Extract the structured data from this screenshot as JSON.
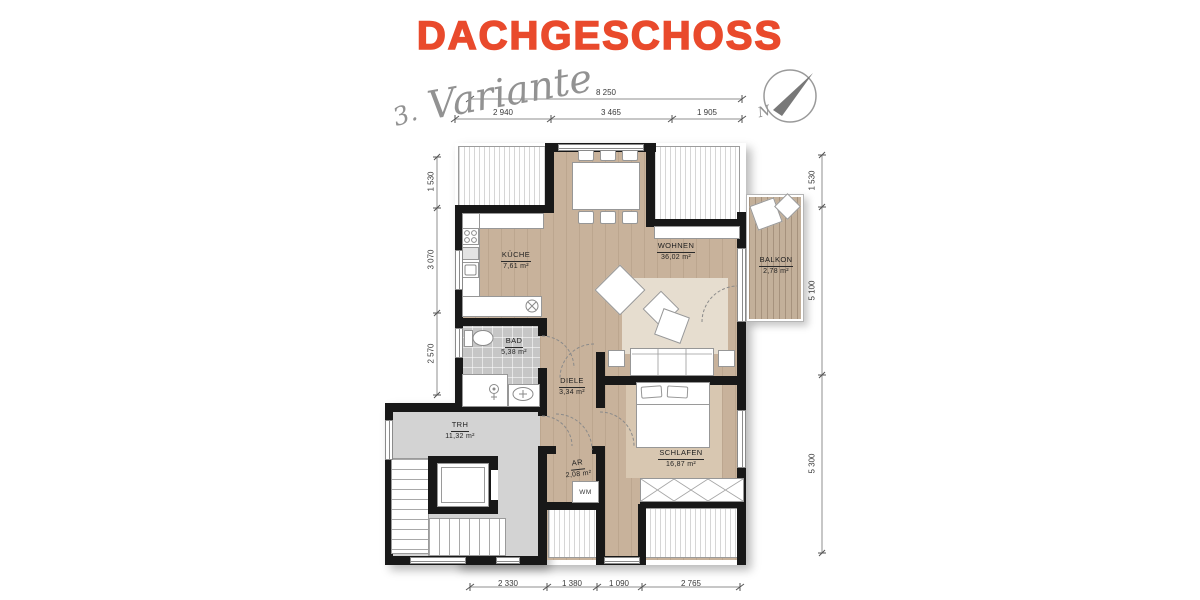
{
  "title": {
    "text": "DACHGESCHOSS"
  },
  "annotation": {
    "number": "3.",
    "word": "Variante"
  },
  "compass": {
    "label": "N"
  },
  "rooms": [
    {
      "name": "KÜCHE",
      "area": "7,61 m²"
    },
    {
      "name": "WOHNEN",
      "area": "36,02 m²"
    },
    {
      "name": "BALKON",
      "area": "2,78 m²"
    },
    {
      "name": "BAD",
      "area": "5,38 m²"
    },
    {
      "name": "DIELE",
      "area": "3,34 m²"
    },
    {
      "name": "TRH",
      "area": "11,32 m²"
    },
    {
      "name": "AR",
      "area": "2,08 m²"
    },
    {
      "name": "SCHLAFEN",
      "area": "16,87 m²"
    }
  ],
  "labels": {
    "washing_machine": "WM"
  },
  "dimensions": {
    "top_total": "8 250",
    "top_segments": [
      "2 940",
      "3 465",
      "1 905"
    ],
    "left": [
      "1 530",
      "3 070",
      "2 570"
    ],
    "right": [
      "1 530",
      "5 100",
      "5 300"
    ],
    "bottom": [
      "2 330",
      "1 380",
      "1 090",
      "2 765"
    ]
  },
  "colors": {
    "title": "#e94a2c",
    "wall": "#181818",
    "wood_floor": "#c8b29b",
    "tile_floor": "#c6c6c6",
    "stair_floor": "#d3d3d3",
    "deck": "#c3b09a",
    "rug": "#e6ddcf"
  }
}
